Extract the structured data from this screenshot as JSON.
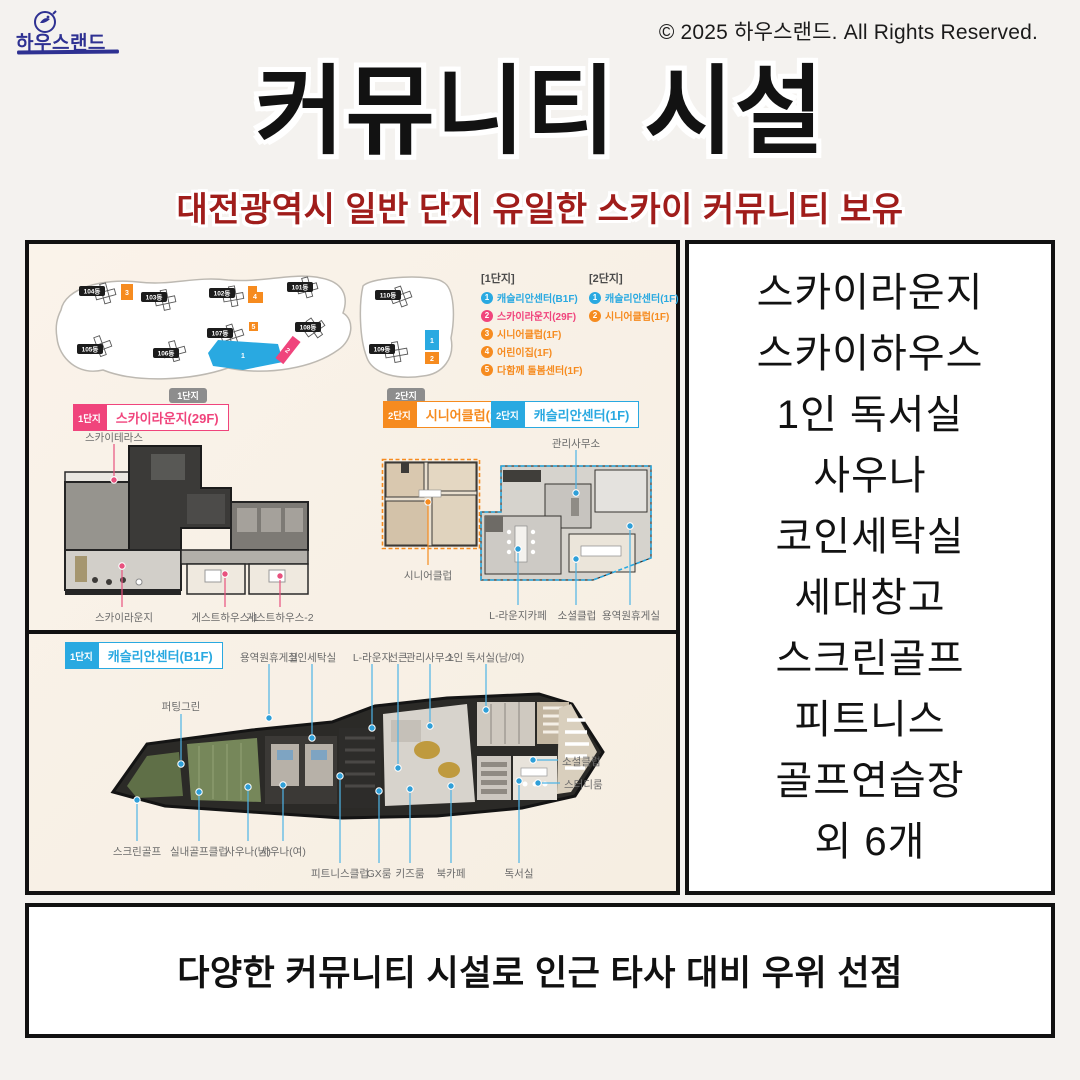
{
  "logo": {
    "text": "하우스랜드"
  },
  "copyright": "© 2025 하우스랜드. All Rights Reserved.",
  "header": {
    "title": "커뮤니티 시설",
    "subtitle": "대전광역시 일반 단지 유일한 스카이 커뮤니티 보유"
  },
  "site_plan": {
    "complex1": {
      "label": "1단지",
      "buildings": [
        "104동",
        "103동",
        "102동",
        "101동",
        "105동",
        "106동",
        "107동",
        "108동"
      ],
      "markers": [
        "1",
        "2",
        "3",
        "4",
        "5"
      ]
    },
    "complex2": {
      "label": "2단지",
      "buildings": [
        "110동",
        "109동"
      ],
      "markers": [
        "1",
        "2"
      ]
    },
    "legend1": {
      "title": "[1단지]",
      "items": [
        {
          "num": "1",
          "label": "캐슬리안센터(B1F)",
          "color": "#29a9e1"
        },
        {
          "num": "2",
          "label": "스카이라운지(29F)",
          "color": "#f0447c"
        },
        {
          "num": "3",
          "label": "시니어클럽(1F)",
          "color": "#f68b1f"
        },
        {
          "num": "4",
          "label": "어린이집(1F)",
          "color": "#f68b1f"
        },
        {
          "num": "5",
          "label": "다함께 돌봄센터(1F)",
          "color": "#f68b1f"
        }
      ]
    },
    "legend2": {
      "title": "[2단지]",
      "items": [
        {
          "num": "1",
          "label": "캐슬리안센터(1F)",
          "color": "#29a9e1"
        },
        {
          "num": "2",
          "label": "시니어클럽(1F)",
          "color": "#f68b1f"
        }
      ]
    }
  },
  "plans": {
    "sky": {
      "badge": "1단지",
      "title": "스카이라운지(29F)",
      "terrace": "스카이테라스",
      "lounge": "스카이라운지",
      "guest1": "게스트하우스-1",
      "guest2": "게스트하우스-2"
    },
    "senior": {
      "badge": "2단지",
      "title": "시니어클럽(1F)",
      "label": "시니어클럽"
    },
    "castlian1f": {
      "badge": "2단지",
      "title": "캐슬리안센터(1F)",
      "office": "관리사무소",
      "cafe": "L-라운지카페",
      "social": "소셜클럽",
      "staff": "용역원휴게실"
    },
    "b1f": {
      "badge": "1단지",
      "title": "캐슬리안센터(B1F)",
      "top": [
        "용역원휴게실",
        "코인세탁실",
        "L-라운지",
        "선큰",
        "관리사무소",
        "1인 독서실(남/여)"
      ],
      "left": "퍼팅그린",
      "right": [
        "소셜클럽",
        "스터디룸"
      ],
      "bottom1": [
        "스크린골프",
        "실내골프클럽",
        "사우나(남)",
        "사우나(여)"
      ],
      "bottom2": [
        "피트니스클럽",
        "GX룸",
        "키즈룸",
        "북카페",
        "독서실"
      ]
    }
  },
  "facilities": [
    "스카이라운지",
    "스카이하우스",
    "1인 독서실",
    "사우나",
    "코인세탁실",
    "세대창고",
    "스크린골프",
    "피트니스",
    "골프연습장",
    "외 6개"
  ],
  "footer": "다양한 커뮤니티 시설로 인근 타사 대비 우위 선점",
  "colors": {
    "accent_blue": "#29a9e1",
    "accent_pink": "#f0447c",
    "accent_orange": "#f68b1f",
    "subtitle_red": "#a01d1b",
    "logo_navy": "#2e3192",
    "panel_cream": "#f9f2e8",
    "border_black": "#111111"
  }
}
